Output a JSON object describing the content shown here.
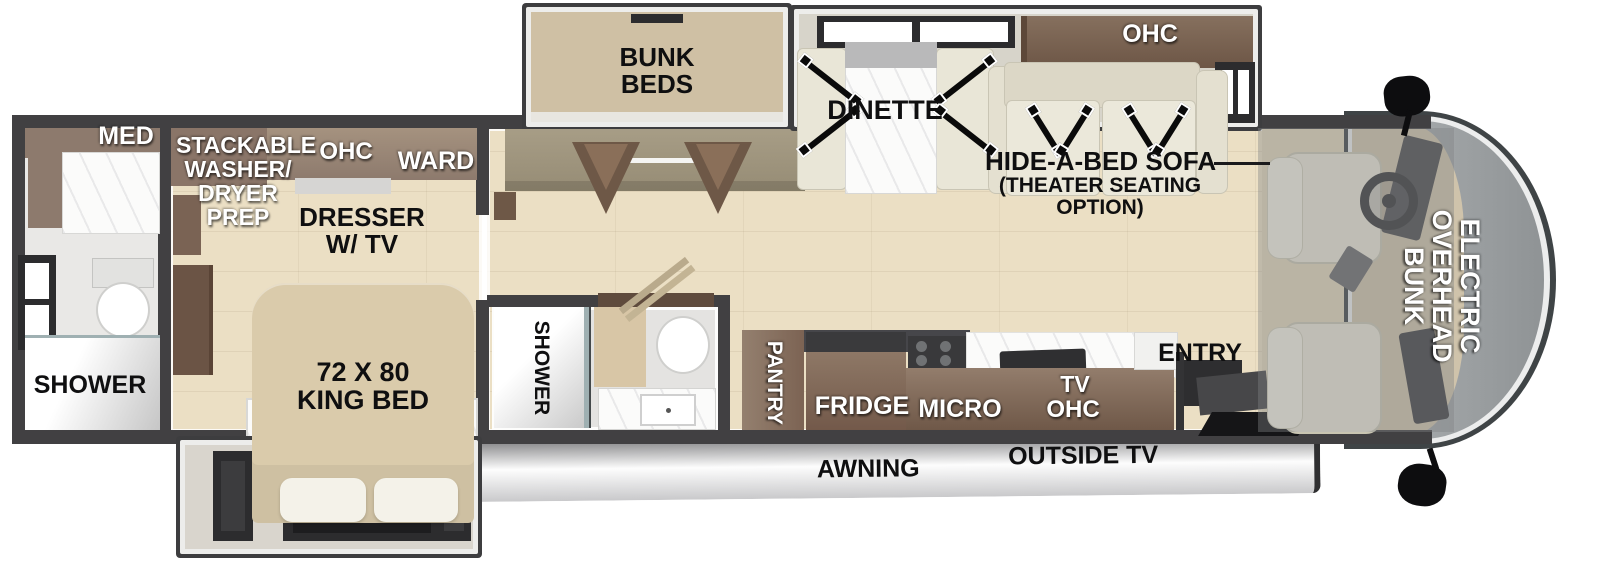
{
  "figure": {
    "type": "rv-floor-plan"
  },
  "colors": {
    "wall": "#414042",
    "floor_wood": "#ebdfc4",
    "cabinet_brown": "#7b6350",
    "cabinet_taupe": "#9d8a7d",
    "bed_tan": "#dacbab",
    "upholstery_cream": "#e9e6d7",
    "awning_gray": "#d3d3d5",
    "glass_gray": "#a5a9ab",
    "strap_black": "#0a0a0a"
  },
  "rooms": {
    "rear_bath": {
      "med": "MED",
      "shower": "SHOWER"
    },
    "bedroom": {
      "washer_lines": [
        "STACKABLE",
        "WASHER/",
        "DRYER",
        "PREP"
      ],
      "ohc": "OHC",
      "ward": "WARD",
      "dresser_lines": [
        "DRESSER",
        "W/ TV"
      ],
      "bed_lines": [
        "72 X 80",
        "KING BED"
      ]
    },
    "mid_bath": {
      "shower": "SHOWER"
    },
    "bunk_room": {
      "lines": [
        "BUNK",
        "BEDS"
      ]
    },
    "dinette": {
      "label": "DINETTE"
    },
    "living": {
      "ohc": "OHC",
      "sofa_lines": [
        "HIDE-A-BED SOFA",
        "(THEATER SEATING",
        "OPTION)"
      ]
    },
    "kitchen": {
      "pantry": "PANTRY",
      "fridge": "FRIDGE",
      "micro": "MICRO",
      "tv": "TV",
      "ohc": "OHC"
    },
    "entry": {
      "label": "ENTRY"
    },
    "cab": {
      "bunk_lines": [
        "ELECTRIC",
        "OVERHEAD",
        "BUNK"
      ]
    },
    "exterior": {
      "awning": "AWNING",
      "outside_tv": "OUTSIDE TV"
    }
  }
}
